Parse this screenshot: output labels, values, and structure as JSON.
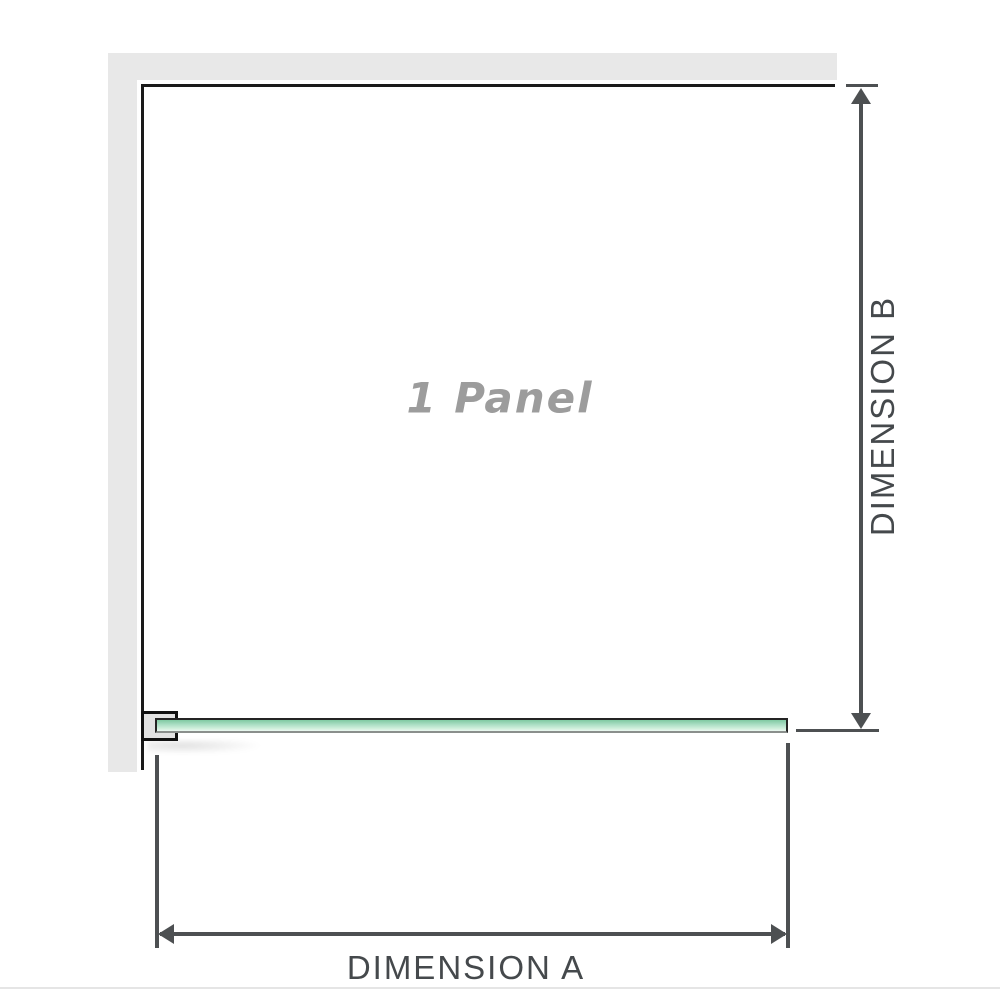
{
  "diagram": {
    "panel_label": "1 Panel",
    "dimension_a_label": "DIMENSION A",
    "dimension_b_label": "DIMENSION B"
  },
  "colors": {
    "wall": "#e8e8e8",
    "outline": "#1a1a1a",
    "glass-top": "#7fc9a2",
    "glass-bottom": "#ecf8f1",
    "bracket-fill": "#e2e2e2",
    "dim-line": "#4d5052",
    "dim-text": "#45494c",
    "panel-text": "#9c9c9c",
    "page-line": "#e5e5e5"
  }
}
